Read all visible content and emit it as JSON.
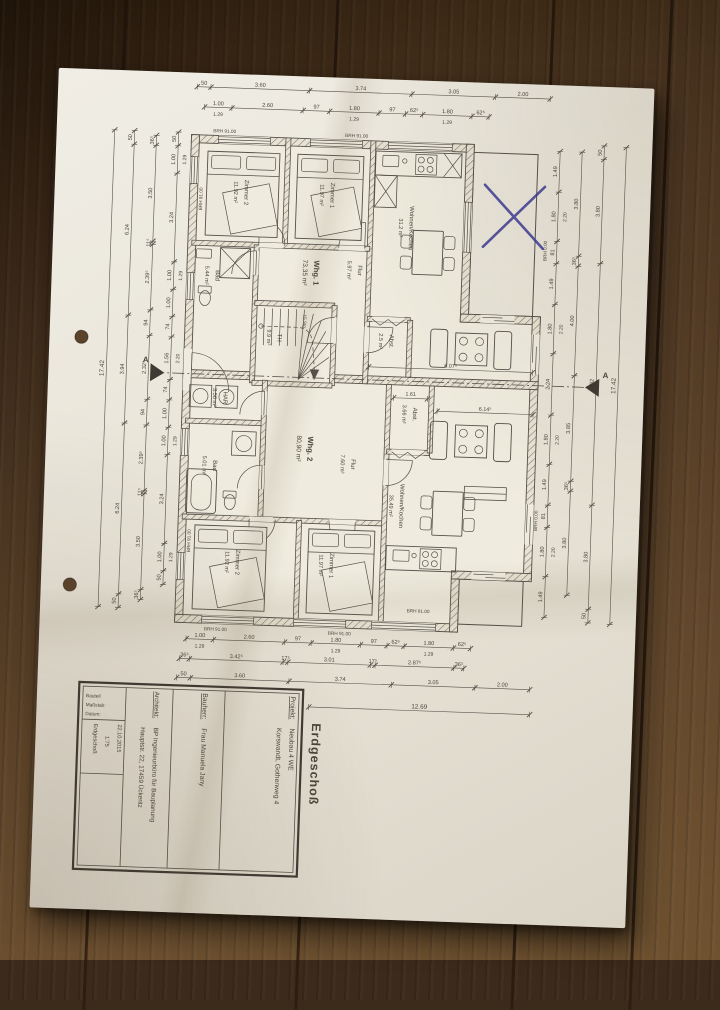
{
  "scene": {
    "surface": "wooden-table",
    "wood_color": "#55402a",
    "paper_color": "#eae6da"
  },
  "sheet": {
    "title": "Erdgeschoß",
    "scale_note": "1:75",
    "date": "22.10.2015",
    "title_block": {
      "projekt_label": "Projekt:",
      "projekt": "Neubau 4 WE",
      "projekt_line2": "Korswandt, Gothenweg 4",
      "bauherr_label": "Bauherr:",
      "bauherr": "Frau Manuela Jany",
      "architekt_label": "Architekt:",
      "architekt": "BP Ingenieurbüro für Bauplanung",
      "architekt_line2": "Hauptstr. 22, 17459 Ückeritz",
      "bauteil_label": "Bauteil",
      "massstab_label": "Maßstab:",
      "datum_label": "Datum:",
      "bauteil": "Erdgeschoß"
    }
  },
  "plan": {
    "apartments": [
      {
        "name": "Whg. 1",
        "area": "73,35 m²"
      },
      {
        "name": "Whg. 2",
        "area": "80,90 m²"
      }
    ],
    "rooms": [
      {
        "id": "w1-z2",
        "name": "Zimmer 2",
        "area": "11.92 m²"
      },
      {
        "id": "w1-z1",
        "name": "Zimmer 1",
        "area": "11.97 m²"
      },
      {
        "id": "w1-flur",
        "name": "Flur",
        "area": "5.97 m²"
      },
      {
        "id": "w1-bad",
        "name": "Bad",
        "area": "5.44 m²"
      },
      {
        "id": "w1-wohnen",
        "name": "Wohnen/Kochen",
        "area": "31.2 m²"
      },
      {
        "id": "w1-abst",
        "name": "Abst.",
        "area": "2.5 m²"
      },
      {
        "id": "th",
        "name": "TH",
        "area": "9.9 m²"
      },
      {
        "id": "w2-har",
        "name": "HAR",
        "area": "3.56 m²"
      },
      {
        "id": "w2-bad",
        "name": "Bad",
        "area": "5.01 m²"
      },
      {
        "id": "w2-abst",
        "name": "Abst.",
        "area": "3.66 m²"
      },
      {
        "id": "w2-flur",
        "name": "Flur",
        "area": "7.60 m²"
      },
      {
        "id": "w2-z2",
        "name": "Zimmer 2",
        "area": "11.92 m²"
      },
      {
        "id": "w2-z1",
        "name": "Zimmer 1",
        "area": "11.97 m²"
      },
      {
        "id": "w2-wohnen",
        "name": "Wohnen/Kochen",
        "area": "35.49 m²"
      }
    ],
    "stair_note": "15 Stg.",
    "section_label": "A",
    "brh_sill": "BRH 91.00",
    "brh_floor": "BRH 0.00",
    "x_mark": {
      "type": "pen-cross",
      "color": "#3c3a96"
    }
  },
  "dims": {
    "outer_h": [
      {
        "t": "50",
        "m": 0.5
      },
      {
        "t": "3.60",
        "m": 3.6
      },
      {
        "t": "3.74",
        "m": 3.74
      },
      {
        "t": "3.05",
        "m": 3.05
      },
      {
        "t": "2.00",
        "m": 2.0
      }
    ],
    "window_h": [
      {
        "t": "1.00",
        "m": 1.0,
        "sub": "1.29"
      },
      {
        "t": "2.60",
        "m": 2.6
      },
      {
        "t": "97",
        "m": 0.97
      },
      {
        "t": "1.80",
        "m": 1.8,
        "sub": "1.29"
      },
      {
        "t": "97",
        "m": 0.97
      },
      {
        "t": "62⁵",
        "m": 0.625
      },
      {
        "t": "1.80",
        "m": 1.8,
        "sub": "1.29"
      },
      {
        "t": "62⁵",
        "m": 0.625
      }
    ],
    "mid_h": [
      {
        "t": "36⁵",
        "m": 0.365
      },
      {
        "t": "3.42⁵",
        "m": 3.425
      },
      {
        "t": "17⁵",
        "m": 0.175
      },
      {
        "t": "3.01",
        "m": 3.01
      },
      {
        "t": "17⁵",
        "m": 0.175
      },
      {
        "t": "2.87⁵",
        "m": 2.875
      },
      {
        "t": "36⁵",
        "m": 0.365
      }
    ],
    "left_inner": [
      {
        "t": "50",
        "m": 0.5
      },
      {
        "t": "1.00",
        "m": 1.0,
        "sub": "1.29"
      },
      {
        "t": "3.24",
        "m": 3.24
      },
      {
        "t": "1.00",
        "m": 1.0,
        "sub": "1.29"
      },
      {
        "t": "1.00",
        "m": 1.0
      },
      {
        "t": "74",
        "m": 0.74
      },
      {
        "t": "1.56",
        "m": 1.56,
        "sub": "2.20"
      },
      {
        "t": "74",
        "m": 0.74
      },
      {
        "t": "1.00",
        "m": 1.0
      },
      {
        "t": "1.00",
        "m": 1.0,
        "sub": "1.29"
      },
      {
        "t": "3.24",
        "m": 3.24
      },
      {
        "t": "1.00",
        "m": 1.0,
        "sub": "1.29"
      },
      {
        "t": "50",
        "m": 0.5
      }
    ],
    "left_mid": [
      {
        "t": "36⁵",
        "m": 0.365
      },
      {
        "t": "3.50",
        "m": 3.5
      },
      {
        "t": "11⁵",
        "m": 0.115
      },
      {
        "t": "2.39⁵",
        "m": 2.395
      },
      {
        "t": "94",
        "m": 0.94
      },
      {
        "t": "2.32⁵",
        "m": 2.325
      },
      {
        "t": "94",
        "m": 0.94
      },
      {
        "t": "2.39⁵",
        "m": 2.395
      },
      {
        "t": "11⁵",
        "m": 0.115
      },
      {
        "t": "3.50",
        "m": 3.5
      },
      {
        "t": "36⁵",
        "m": 0.365
      }
    ],
    "left_outer": [
      {
        "t": "50",
        "m": 0.5
      },
      {
        "t": "6.24",
        "m": 6.24
      },
      {
        "t": "3.94",
        "m": 3.94
      },
      {
        "t": "6.24",
        "m": 6.24
      },
      {
        "t": "50",
        "m": 0.5
      }
    ],
    "right_inner": [
      {
        "t": "1.49",
        "m": 1.49
      },
      {
        "t": "1.80",
        "m": 1.8,
        "sub": "2.20"
      },
      {
        "t": "81",
        "m": 0.81
      },
      {
        "t": "1.49",
        "m": 1.49
      },
      {
        "t": "1.80",
        "m": 1.8,
        "sub": "2.20"
      },
      {
        "t": "2.24",
        "m": 2.24
      },
      {
        "t": "1.80",
        "m": 1.8,
        "sub": "2.20"
      },
      {
        "t": "1.49",
        "m": 1.49
      },
      {
        "t": "81",
        "m": 0.81
      },
      {
        "t": "1.80",
        "m": 1.8,
        "sub": "2.20"
      },
      {
        "t": "1.49",
        "m": 1.49
      }
    ],
    "right_mid": [
      {
        "t": "3.80",
        "m": 3.8
      },
      {
        "t": "36⁵",
        "m": 0.365
      },
      {
        "t": "4.00",
        "m": 4.0
      },
      {
        "t": "3.85",
        "m": 3.85
      },
      {
        "t": "36⁵",
        "m": 0.365
      },
      {
        "t": "3.80",
        "m": 3.8
      }
    ],
    "right_outer": [
      {
        "t": "50",
        "m": 0.5
      },
      {
        "t": "3.80",
        "m": 3.8
      },
      {
        "t": "8.82",
        "m": 8.82
      },
      {
        "t": "3.80",
        "m": 3.8
      },
      {
        "t": "50",
        "m": 0.5
      }
    ],
    "total_width": {
      "t": "12.69",
      "m": 12.69
    },
    "total_depth": {
      "t": "17.42",
      "m": 17.42
    },
    "interior": [
      {
        "t": "6.07⁵"
      },
      {
        "t": "6.14⁵"
      },
      {
        "t": "1.61"
      }
    ]
  }
}
